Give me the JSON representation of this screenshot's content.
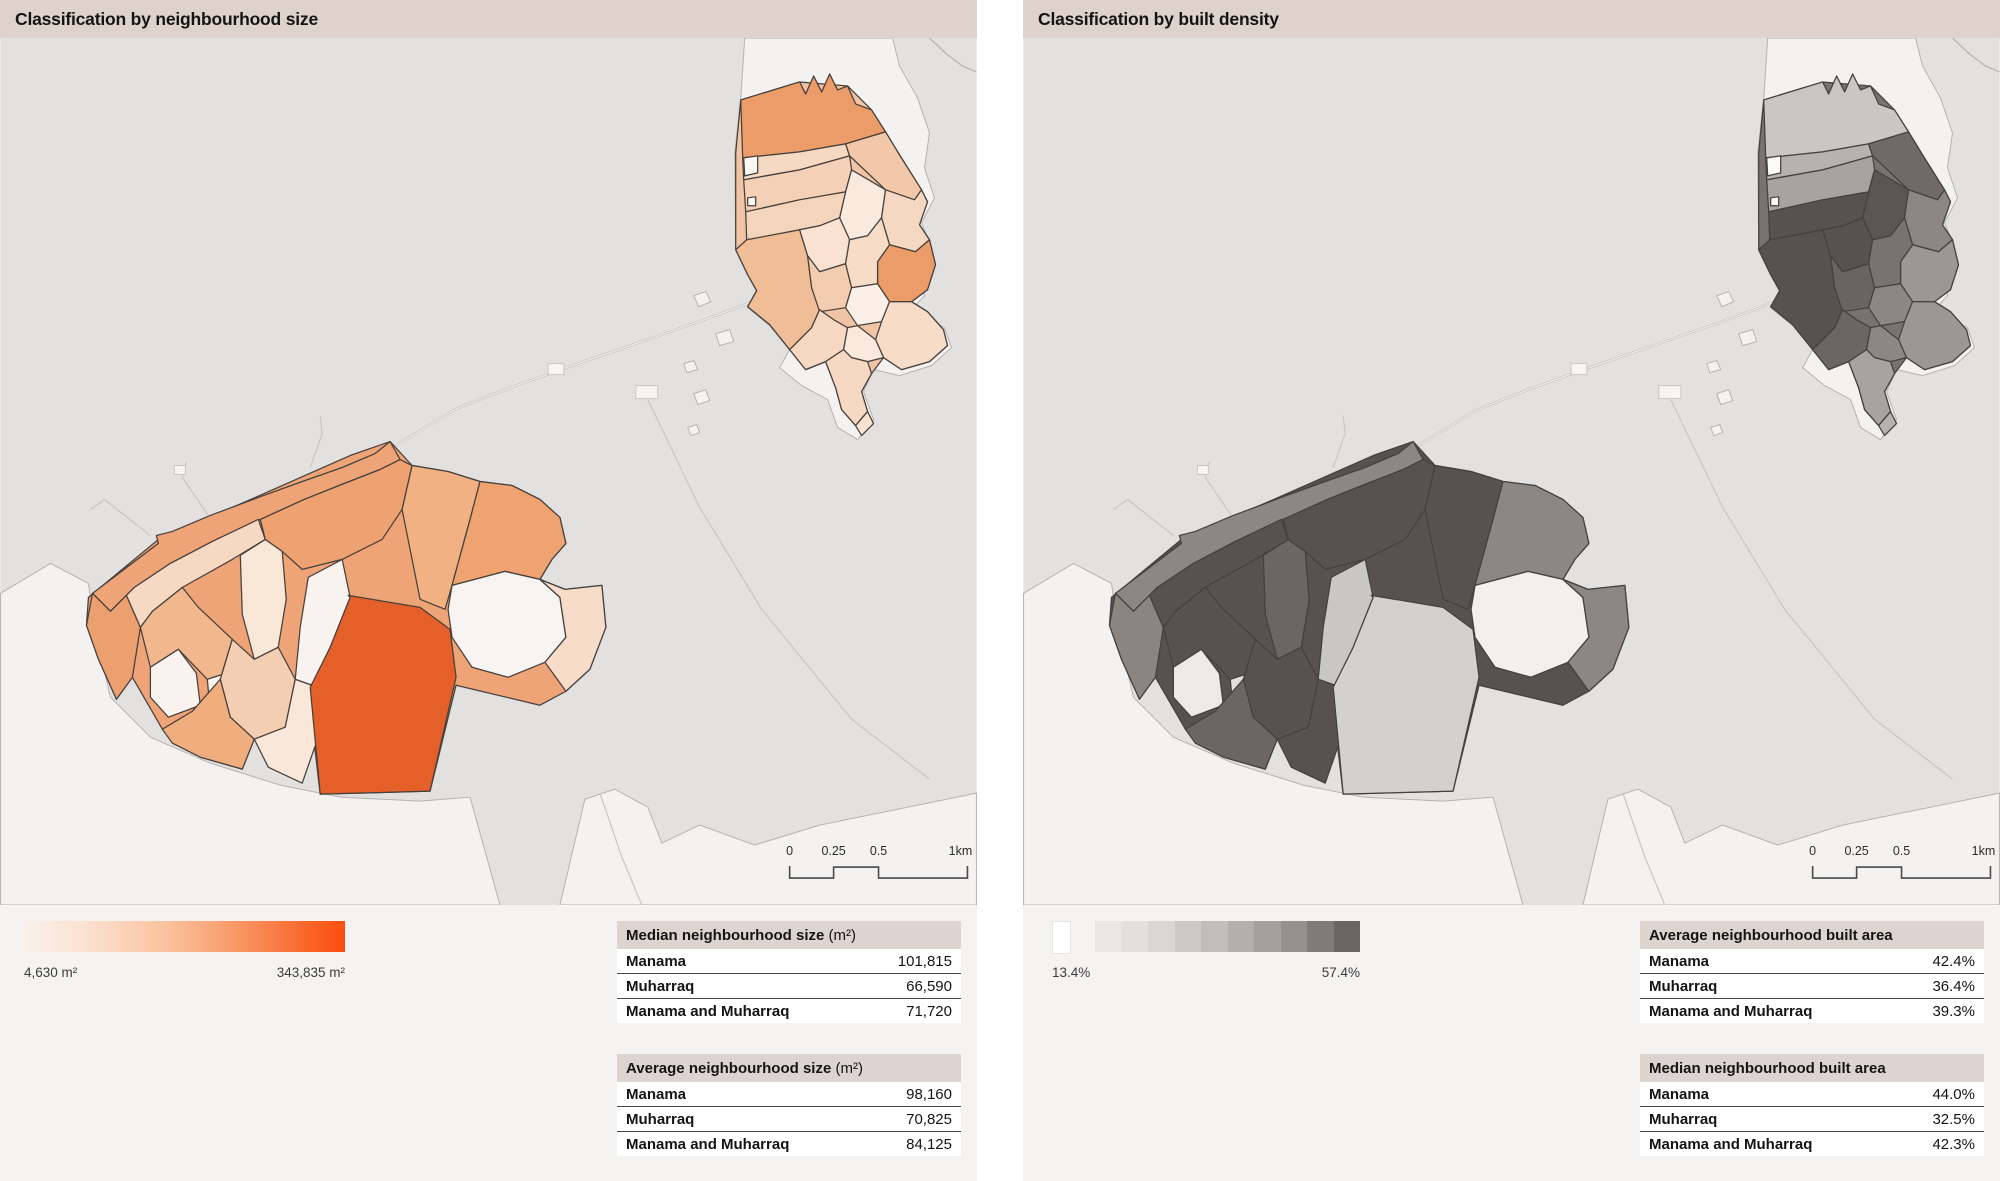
{
  "panels": [
    {
      "id": "size",
      "title": "Classification by neighbourhood size",
      "legend": {
        "type": "continuous",
        "min_label": "4,630 m²",
        "max_label": "343,835 m²",
        "stops": [
          "#f8f1ec",
          "#fae9de",
          "#fbe2d2",
          "#fbd7c1",
          "#fbccae",
          "#fbc09a",
          "#fab086",
          "#f99d6d",
          "#f98a55",
          "#f9753c",
          "#fa6022",
          "#fb4e10"
        ]
      },
      "scalebar": {
        "labels": [
          "0",
          "0.25",
          "0.5",
          "1km"
        ]
      },
      "tables": [
        {
          "title": "Median neighbourhood size",
          "unit": " (m²)",
          "rows": [
            [
              "Manama",
              "101,815"
            ],
            [
              "Muharraq",
              "66,590"
            ],
            [
              "Manama and Muharraq",
              "71,720"
            ]
          ]
        },
        {
          "title": "Average neighbourhood size",
          "unit": " (m²)",
          "rows": [
            [
              "Manama",
              "98,160"
            ],
            [
              "Muharraq",
              "70,825"
            ],
            [
              "Manama and Muharraq",
              "84,125"
            ]
          ]
        }
      ],
      "map_fills": {
        "mu-base": "#f0c4a4",
        "m1": "#eb9c68",
        "m2": "#f6d9c3",
        "m3": "#f2c8a8",
        "m4": "#f4d0b6",
        "m5": "#faeadd",
        "m6": "#f6d8c2",
        "m7": "#eb9c68",
        "m8": "#f5d4bc",
        "m9": "#f1bd96",
        "m10": "#f9e2d1",
        "m11": "#f4cdb1",
        "m12": "#f7dcc8",
        "m13": "#faf0e8",
        "m14": "#f7dcc8",
        "m15": "#f6d8c3",
        "m16": "#fae9dc",
        "m17": "#f6d8c3",
        "m18": "#f9e4d4",
        "m2w": "#faf7f5",
        "m4w": "#faf7f5",
        "ma-base": "#efa478",
        "a1": "#efa478",
        "a2": "#eda06f",
        "a3": "#f6d8c3",
        "a5": "#f1b88e",
        "a4": "#f8f3ef",
        "a4b": "#f8f3ef",
        "a6": "#f8e7d6",
        "a7": "#efa271",
        "a8": "#f2b182",
        "a9": "#efa370",
        "a10": "#f4ceb2",
        "a11": "#f0ad7e",
        "a12": "#f9e8da",
        "a13": "#f8f3ef",
        "a14": "#e55f28",
        "hole1": "#f7f4f1",
        "a15": "#f7dcc9"
      }
    },
    {
      "id": "density",
      "title": "Classification by built density",
      "legend": {
        "type": "stepped",
        "min_label": "13.4%",
        "max_label": "57.4%",
        "zero_swatch": "#ffffff",
        "steps": [
          "#e9e7e5",
          "#e2e0de",
          "#d9d7d5",
          "#cbc9c7",
          "#c0bebc",
          "#b2afad",
          "#a3a09e",
          "#94908e",
          "#7f7b79",
          "#6a6462"
        ]
      },
      "scalebar": {
        "labels": [
          "0",
          "0.25",
          "0.5",
          "1km"
        ]
      },
      "tables": [
        {
          "title": "Average neighbourhood built area",
          "unit": "",
          "rows": [
            [
              "Manama",
              "42.4%"
            ],
            [
              "Muharraq",
              "36.4%"
            ],
            [
              "Manama and Muharraq",
              "39.3%"
            ]
          ]
        },
        {
          "title": "Median neighbourhood built area",
          "unit": "",
          "rows": [
            [
              "Manama",
              "44.0%"
            ],
            [
              "Muharraq",
              "32.5%"
            ],
            [
              "Manama and Muharraq",
              "42.3%"
            ]
          ]
        }
      ],
      "map_fills": {
        "mu-base": "#787371",
        "m1": "#c9c7c6",
        "m2": "#b5b2b1",
        "m3": "#6f6a68",
        "m4": "#a6a3a1",
        "m5": "#5b5553",
        "m6": "#8d8783",
        "m7": "#9b9795",
        "m8": "#575150",
        "m9": "#575150",
        "m10": "#575150",
        "m11": "#696361",
        "m12": "#787371",
        "m13": "#8d8784",
        "m14": "#9b9795",
        "m15": "#6b6563",
        "m16": "#8d8784",
        "m17": "#a6a3a1",
        "m18": "#b5b2b1",
        "m2w": "#fbfaf9",
        "m4w": "#fbfaf9",
        "ma-base": "#575150",
        "a1": "#8d8784",
        "a2": "#8b8582",
        "a3": "#575150",
        "a5": "#575150",
        "a4": "#eceae8",
        "a4b": "#e2e0de",
        "a6": "#6b6563",
        "a7": "#575150",
        "a8": "#575150",
        "a9": "#8d8784",
        "a10": "#575150",
        "a11": "#6b6563",
        "a12": "#575150",
        "a13": "#c9c7c6",
        "a14": "#d3d1d0",
        "hole1": "#f2f0ee",
        "a15": "#8d8784"
      }
    }
  ],
  "map": {
    "colors": {
      "sea": "#e3e1e0",
      "land": "#f4f2f0",
      "coast": "#b5b3b1",
      "border": "#46403c",
      "road": "#c8c6c4",
      "page_bg": "#f5f3f1",
      "titlebar_bg": "#ddd2cc",
      "table_header_bg": "#ded4cf",
      "accent_orange": "#fb4e10",
      "accent_gray": "#6a6462"
    },
    "geometry": {
      "cells": [
        {
          "id": "mu-base",
          "d": "M741,62 L800,44 L848,48 L872,72 L886,94 L900,117 L922,152 L928,164 L920,187 L930,202 L936,227 L928,252 L912,264 L928,274 L944,292 L948,308 L930,324 L902,332 L884,320 L872,336 L862,354 L868,374 L856,388 L842,372 L836,350 L826,324 L806,332 L790,312 L770,287 L748,269 L757,253 L748,237 L736,212 L736,115 Z"
        },
        {
          "id": "m1",
          "d": "M741,62 L800,44 L806,56 L814,38 L822,54 L830,36 L838,52 L848,48 L856,66 L872,72 L886,94 L846,106 L800,114 L743,120 Z"
        },
        {
          "id": "m2",
          "d": "M743,120 L800,114 L846,106 L850,118 L800,132 L744,142 Z"
        },
        {
          "id": "m3",
          "d": "M846,106 L886,94 L900,117 L922,152 L915,162 L886,152 L850,118 Z"
        },
        {
          "id": "m4",
          "d": "M744,142 L800,132 L850,118 L852,132 L846,154 L800,162 L746,174 Z"
        },
        {
          "id": "m5",
          "d": "M846,154 L852,132 L886,152 L882,180 L868,198 L850,202 L840,180 Z"
        },
        {
          "id": "m6",
          "d": "M886,152 L915,162 L922,152 L928,164 L920,187 L930,202 L916,214 L890,207 L882,180 Z"
        },
        {
          "id": "m7",
          "d": "M890,207 L916,214 L930,202 L936,227 L928,252 L912,264 L890,264 L878,246 L878,224 Z"
        },
        {
          "id": "m8",
          "d": "M746,174 L800,162 L846,154 L840,180 L820,188 L800,192 L760,200 L747,202 Z"
        },
        {
          "id": "m9",
          "d": "M747,202 L790,194 L800,192 L808,218 L812,250 L820,272 L812,290 L790,312 L770,287 L748,269 L757,253 L748,237 L736,212 Z"
        },
        {
          "id": "m10",
          "d": "M800,192 L820,188 L840,180 L850,202 L846,226 L820,234 L808,218 Z"
        },
        {
          "id": "m11",
          "d": "M808,218 L820,234 L846,226 L852,250 L846,270 L820,274 L812,250 Z"
        },
        {
          "id": "m12",
          "d": "M850,202 L868,198 L882,180 L890,207 L878,224 L878,246 L852,250 L846,226 Z"
        },
        {
          "id": "m13",
          "d": "M852,250 L878,246 L890,264 L882,284 L858,288 L846,270 Z"
        },
        {
          "id": "m14",
          "d": "M882,284 L890,264 L912,264 L928,274 L944,292 L948,308 L930,324 L902,332 L884,320 L876,302 Z"
        },
        {
          "id": "m15",
          "d": "M790,312 L812,290 L820,272 L834,282 L848,290 L844,312 L826,324 L806,332 Z"
        },
        {
          "id": "m16",
          "d": "M848,290 L858,288 L876,302 L884,320 L868,324 L852,320 L844,312 Z"
        },
        {
          "id": "m17",
          "d": "M826,324 L844,312 L852,320 L868,324 L872,336 L862,354 L868,374 L856,388 L842,372 L836,350 Z"
        },
        {
          "id": "m18",
          "d": "M856,388 L868,374 L874,386 L862,398 Z"
        },
        {
          "id": "m2w",
          "d": "M744,120 L758,118 L758,135 L745,138 Z"
        },
        {
          "id": "m4w",
          "d": "M748,160 L756,159 L756,168 L748,168 Z"
        },
        {
          "id": "ma-base",
          "d": "M88,560 L158,502 L255,460 L350,418 L390,404 L412,428 L448,434 L480,444 L512,448 L540,462 L560,480 L566,506 L552,522 L540,542 L565,552 L602,548 L606,590 L590,632 L566,654 L540,668 L456,648 L430,754 L320,757 L308,654 L295,642 L285,690 L254,702 L242,732 L200,720 L162,692 L132,640 L116,662 L98,622 L86,588 Z"
        },
        {
          "id": "a1",
          "d": "M92,556 L158,506 L156,498 L172,494 L210,478 L258,460 L302,444 L342,430 L375,416 L390,404 L400,422 L380,432 L344,446 L304,462 L260,482 L212,504 L170,526 L134,550 L110,574 Z"
        },
        {
          "id": "a2",
          "d": "M92,556 L110,574 L126,558 L140,590 L132,640 L116,662 L98,622 L86,588 Z"
        },
        {
          "id": "a3",
          "d": "M134,550 L170,526 L212,504 L258,482 L265,502 L232,522 L182,550 L152,574 L140,590 L126,558 Z"
        },
        {
          "id": "a5",
          "d": "M140,590 L152,574 L182,550 L198,570 L232,602 L220,642 L207,642 L178,612 L150,630 Z"
        },
        {
          "id": "a4",
          "d": "M150,630 L178,612 L196,636 L200,668 L168,680 L150,660 Z"
        },
        {
          "id": "a4b",
          "d": "M207,642 L232,634 L240,660 L228,684 L210,676 Z"
        },
        {
          "id": "a6",
          "d": "M240,518 L265,502 L282,514 L286,562 L278,610 L254,622 L242,577 Z"
        },
        {
          "id": "a7",
          "d": "M260,482 L304,462 L344,446 L380,432 L400,422 L412,428 L402,472 L382,502 L342,522 L302,532 L282,514 L265,502 Z"
        },
        {
          "id": "a8",
          "d": "M412,428 L448,434 L480,444 L470,482 L452,548 L445,572 L420,562 L402,472 Z"
        },
        {
          "id": "a9",
          "d": "M480,444 L512,448 L540,462 L560,480 L566,506 L552,522 L540,542 L505,534 L452,548 L470,482 Z"
        },
        {
          "id": "a10",
          "d": "M220,642 L232,602 L254,622 L278,610 L295,642 L285,690 L254,702 L230,680 Z"
        },
        {
          "id": "a11",
          "d": "M162,692 L192,674 L220,642 L230,680 L254,702 L242,732 L200,720 L172,706 Z"
        },
        {
          "id": "a12",
          "d": "M254,702 L285,690 L295,642 L312,648 L318,700 L302,746 L268,730 Z"
        },
        {
          "id": "a13",
          "d": "M308,540 L342,522 L350,560 L330,610 L312,648 L295,642 L300,590 Z"
        },
        {
          "id": "a14",
          "d": "M348,558 L420,570 L450,592 L456,640 L430,754 L320,757 L310,650 L330,610 L350,560 Z"
        },
        {
          "id": "hole1",
          "d": "M452,548 L505,534 L540,542 L560,560 L566,600 L545,625 L508,640 L472,630 L452,600 L448,572 Z"
        },
        {
          "id": "a15",
          "d": "M540,542 L565,552 L602,548 L606,590 L590,632 L566,654 L545,625 L566,600 L560,560 Z"
        }
      ]
    }
  }
}
